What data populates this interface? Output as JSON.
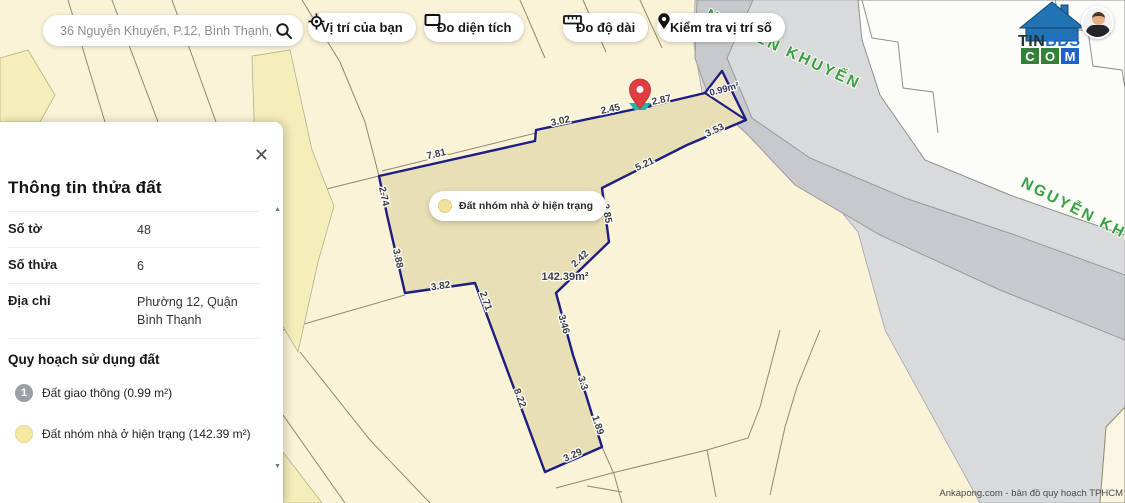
{
  "search": {
    "value": "36 Nguyễn Khuyến, P.12, Bình Thạnh, H"
  },
  "toolbar": {
    "buttons": [
      {
        "label": "Vị trí của bạn",
        "icon": "locate-icon"
      },
      {
        "label": "Đo diện tích",
        "icon": "area-rectangle-icon"
      },
      {
        "label": "Đo độ dài",
        "icon": "ruler-icon"
      },
      {
        "label": "Kiểm tra vị trí số",
        "icon": "pin-icon"
      }
    ]
  },
  "brand": {
    "tin": "TIN",
    "bds": "BDS",
    "c": "C",
    "o": "O",
    "m": "M"
  },
  "panel": {
    "title": "Thông tin thửa đất",
    "close_label": "✕",
    "rows": [
      {
        "label": "Số tờ",
        "value": "48"
      },
      {
        "label": "Số thửa",
        "value": "6"
      },
      {
        "label": "Địa chỉ",
        "value": "Phường 12, Quận Bình Thạnh"
      }
    ],
    "section": "Quy hoạch sử dụng đất",
    "legend": [
      {
        "marker": "1",
        "marker_color": "#9aa0a6",
        "label": "Đất giao thông (0.99 m²)"
      },
      {
        "marker": "",
        "marker_color": "#f5e7a2",
        "label": "Đất nhóm nhà ở hiện trạng (142.39 m²)"
      }
    ],
    "scroll_up": "▲",
    "scroll_down": "▼"
  },
  "map": {
    "parcel_label": "Đất nhóm nhà ở hiện trạng",
    "measurements": [
      {
        "v": "7.81",
        "x": 437,
        "y": 157,
        "r": -13
      },
      {
        "v": "3.02",
        "x": 561,
        "y": 124,
        "r": -12
      },
      {
        "v": "2.45",
        "x": 611,
        "y": 112,
        "r": -12
      },
      {
        "v": "2.87",
        "x": 662,
        "y": 103,
        "r": -12
      },
      {
        "v": "3.53",
        "x": 716,
        "y": 133,
        "r": -25
      },
      {
        "v": "5.21",
        "x": 646,
        "y": 167,
        "r": -25
      },
      {
        "v": "2.85",
        "x": 604,
        "y": 214,
        "r": 80
      },
      {
        "v": "2.42",
        "x": 582,
        "y": 261,
        "r": -44
      },
      {
        "v": "3.46",
        "x": 561,
        "y": 325,
        "r": 74
      },
      {
        "v": "3.3",
        "x": 580,
        "y": 384,
        "r": 72
      },
      {
        "v": "1.89",
        "x": 595,
        "y": 426,
        "r": 72
      },
      {
        "v": "3.29",
        "x": 574,
        "y": 458,
        "r": -24
      },
      {
        "v": "8.22",
        "x": 517,
        "y": 399,
        "r": 70
      },
      {
        "v": "2.71",
        "x": 483,
        "y": 302,
        "r": 70
      },
      {
        "v": "3.82",
        "x": 441,
        "y": 289,
        "r": -8
      },
      {
        "v": "3.88",
        "x": 395,
        "y": 259,
        "r": 78
      },
      {
        "v": "2.74",
        "x": 381,
        "y": 197,
        "r": 78
      }
    ],
    "area_labels": [
      {
        "v": "142.39m²",
        "x": 565,
        "y": 280,
        "r": 0,
        "size": 11,
        "color": "#3c3c3c"
      },
      {
        "v": "0.99m²",
        "x": 725,
        "y": 92,
        "r": -15,
        "size": 9.5,
        "color": "#33335a"
      }
    ],
    "streets": [
      {
        "name": "NGUYỄN KHUYẾN",
        "x": 705,
        "y": 18,
        "r": 25
      },
      {
        "name": "NGUYỄN KHUYẾN",
        "x": 1020,
        "y": 186,
        "r": 27
      }
    ],
    "credit": "Ankapong.com - bản đồ quy hoạch TPHCM"
  },
  "colors": {
    "background_cream": "#faf3d8",
    "parcel_fill": "#e8dfb5",
    "parcel_outline": "#1d1d83",
    "road_gray": "#c7c9cc",
    "area_gray": "#d9dadc",
    "street_green": "#2f9b3f",
    "pin_red": "#e23e41",
    "pin_base_teal": "#29b6a8",
    "planning_yellow": "#f5e7a2"
  }
}
